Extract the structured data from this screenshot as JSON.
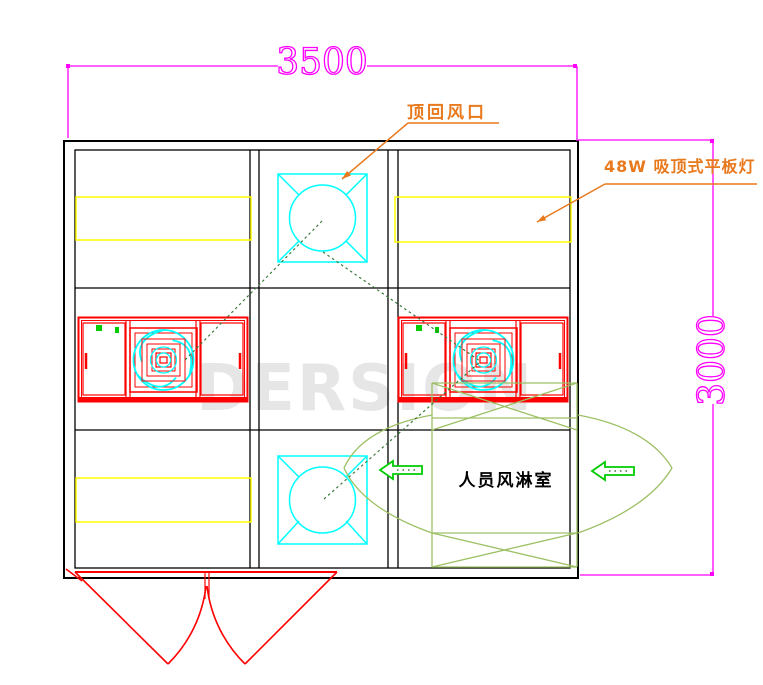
{
  "drawing": {
    "title_hint": "clean-room air shower plan view",
    "dimensions": {
      "width_label": "3500",
      "height_label": "3000"
    },
    "labels": {
      "top_return_air": "顶回风口",
      "ceiling_lamp": "48W 吸顶式平板灯",
      "air_shower_room": "人员风淋室"
    },
    "watermark": {
      "text": "DERSION"
    },
    "icons": [
      "ceiling-return-air-diffuser-icon",
      "fan-filter-unit-icon",
      "flat-panel-lamp-icon",
      "double-swing-door-icon",
      "airflow-arrow-icon",
      "door-swing-arc-icon"
    ],
    "colors": {
      "dimension_magenta": "#FF00FF",
      "annotation_orange": "#E8791D",
      "equipment_red": "#FF0000",
      "diffuser_cyan": "#00FFFF",
      "lamp_yellow": "#FFFF00",
      "arrow_green": "#00CC00",
      "air_shower_green": "#9DC064",
      "leader_dark_green": "#3A7A3A",
      "wall_black": "#000000",
      "watermark_gray": "#E6E6E6"
    }
  }
}
